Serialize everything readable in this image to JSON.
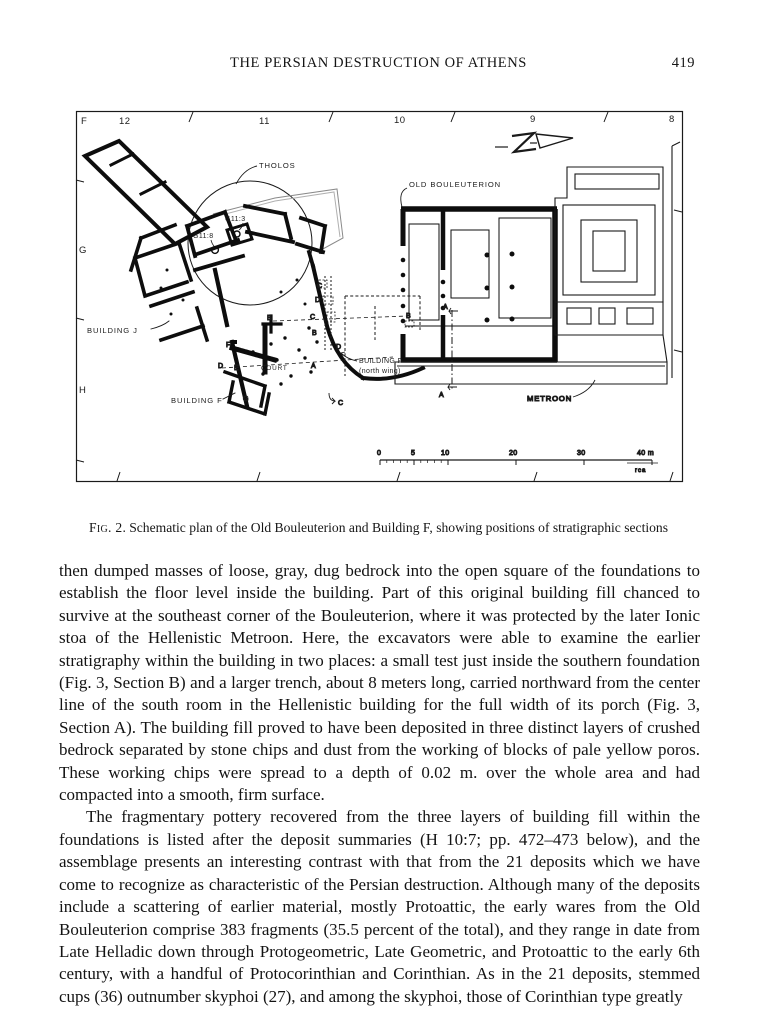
{
  "header": {
    "title": "THE PERSIAN DESTRUCTION OF ATHENS",
    "page_number": "419"
  },
  "figure": {
    "caption_label": "Fig. 2.",
    "caption_text": "Schematic plan of the Old Bouleuterion and Building F, showing positions of stratigraphic sections",
    "grid": {
      "top": [
        "12",
        "11",
        "10",
        "9",
        "8"
      ],
      "left": [
        "F",
        "G",
        "H"
      ]
    },
    "labels": {
      "tholos": "THOLOS",
      "old_bouleuterion": "OLD  BOULEUTERION",
      "metroon": "METROON",
      "building_j": "BUILDING  J",
      "building_f": "BUILDING  F",
      "north_wing_line1": "BUILDING F",
      "north_wing_line2": "(north wing)",
      "court": "COURT",
      "well_g11_3": "G11:3",
      "well_g11_8": "G11:8"
    },
    "sections": [
      "C",
      "D",
      "C",
      "B",
      "D",
      "B",
      "D",
      "E",
      "A",
      "G",
      "C",
      "A",
      "A",
      "B",
      "F"
    ],
    "scale": {
      "labels": [
        "0",
        "5",
        "10",
        "20",
        "30",
        "40 m"
      ],
      "credit": "rca"
    }
  },
  "body": {
    "paragraphs": [
      "then dumped masses of loose, gray, dug bedrock into the open square of the foundations to establish the floor level inside the building. Part of this original building fill chanced to survive at the southeast corner of the Bouleuterion, where it was protected by the later Ionic stoa of the Hellenistic Metroon. Here, the excavators were able to examine the earlier stratigraphy within the building in two places:  a small test just inside the southern foundation (Fig. 3, Section B) and a larger trench, about 8 meters long, carried northward from the center line of the south room in the Hellenistic building for the full width of its porch (Fig. 3, Section A). The building fill proved to have been deposited in three distinct layers of crushed bedrock separated by stone chips and dust from the working of blocks of pale yellow poros. These working chips were spread to a depth of 0.02 m. over the whole area and had compacted into a smooth, firm surface.",
      "The fragmentary pottery recovered from the three layers of building fill within the foundations is listed after the deposit summaries (H 10:7; pp. 472–473 below), and the assemblage presents an interesting contrast with that from the 21 deposits which we have come to recognize as characteristic of the Persian destruction. Although many of the deposits include a scattering of earlier material, mostly Protoattic, the early wares from the Old Bouleuterion comprise 383 fragments (35.5 percent of the total), and they range in date from Late Helladic down through Protogeometric, Late Geometric, and Protoattic to the early 6th century, with a handful of Protocorinthian and Corinthian. As in the 21 deposits, stemmed cups (36) outnumber skyphoi (27), and among the skyphoi, those of Corinthian type greatly"
    ]
  }
}
